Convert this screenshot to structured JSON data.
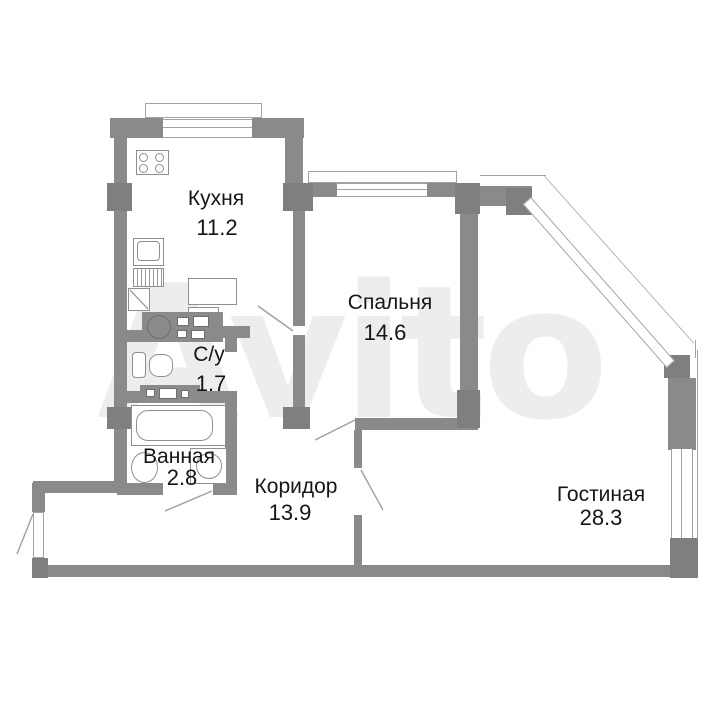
{
  "plan_title": "apartment floor plan",
  "watermark": "Avito",
  "colors": {
    "wall": "#8a8a8a",
    "thin_line": "#a3a3a3",
    "text": "#161616",
    "watermark": "#ededed"
  },
  "rooms": {
    "kitchen": {
      "name": "Кухня",
      "area": "11.2"
    },
    "bedroom": {
      "name": "Спальня",
      "area": "14.6"
    },
    "toilet": {
      "name": "С/у",
      "area": "1.7"
    },
    "bathroom": {
      "name": "Ванная",
      "area": "2.8"
    },
    "corridor": {
      "name": "Коридор",
      "area": "13.9"
    },
    "living": {
      "name": "Гостиная",
      "area": "28.3"
    }
  },
  "fixtures": [
    "stove",
    "kitchen-sink",
    "corner-cabinet",
    "kitchen-counter",
    "table",
    "toilet",
    "bathtub",
    "bath-sink",
    "washing-machine",
    "cabinet-row"
  ],
  "features": [
    "diagonal-glazed-corner",
    "windows",
    "door-swings",
    "entrance-door"
  ]
}
